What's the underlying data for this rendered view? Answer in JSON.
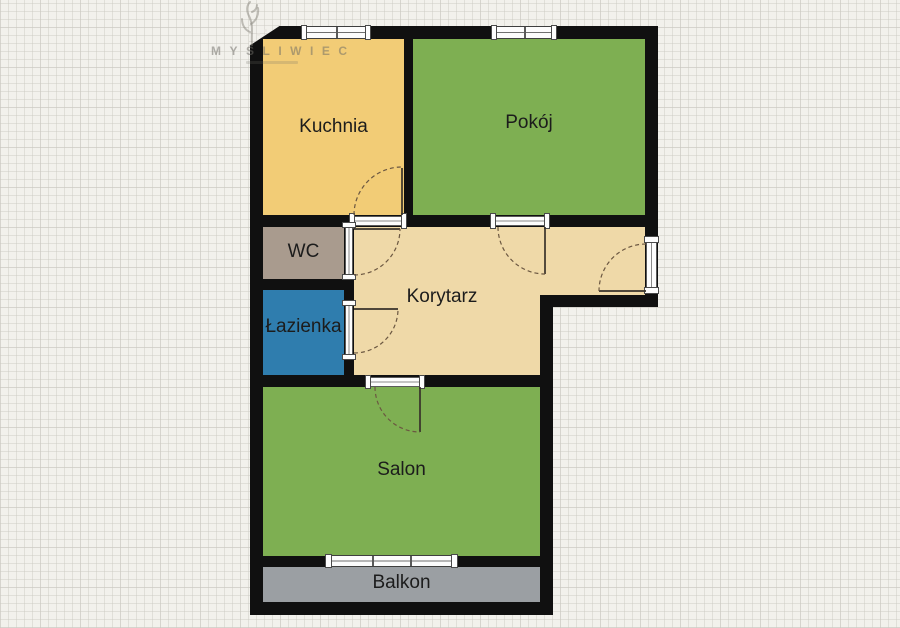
{
  "watermark": {
    "brand": "MYŚLIWIEC"
  },
  "rooms": {
    "kuchnia": {
      "label": "Kuchnia",
      "color": "#F2CC76"
    },
    "pokoj": {
      "label": "Pokój",
      "color": "#7EAF52"
    },
    "wc": {
      "label": "WC",
      "color": "#A99B8E"
    },
    "lazienka": {
      "label": "Łazienka",
      "color": "#2F7DAE"
    },
    "korytarz": {
      "label": "Korytarz",
      "color": "#EFD9A8"
    },
    "salon": {
      "label": "Salon",
      "color": "#7EAF52"
    },
    "balkon": {
      "label": "Balkon",
      "color": "#9B9FA3"
    }
  },
  "colors": {
    "wall": "#101010",
    "background": "#F2F1EC",
    "window_frame": "#FCFCFC",
    "door_leaf": "#38322A",
    "door_arc": "#6B5741"
  }
}
